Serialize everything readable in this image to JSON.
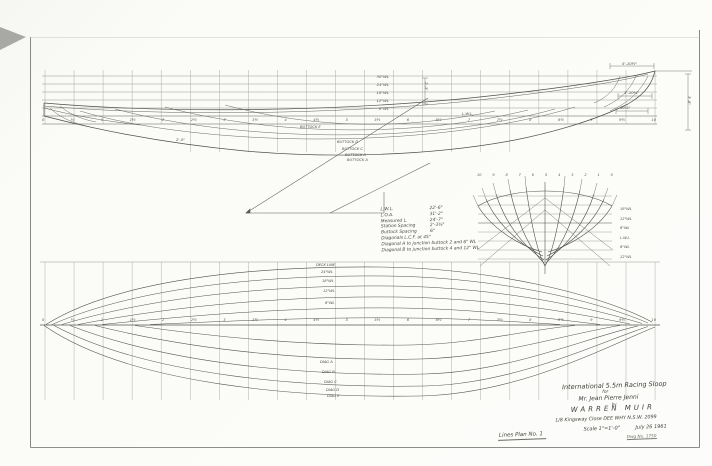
{
  "sheet": {
    "footer_label": "Lines Plan No. 1"
  },
  "title_block": {
    "boat_type": "International 5.5m Racing Sloop",
    "for_word": "for",
    "client": "Mr. Jean Pierre Jenni",
    "by_word": "by",
    "designer": "WARREN  MUIR",
    "address": "1/8 Kingsway Close   DEE WHY   N.S.W. 2099",
    "scale": "Scale 1\"=1'-0\"",
    "date": "July 26 1961",
    "dwg_no": "Dwg No. 1750"
  },
  "spec_table": {
    "rows": [
      [
        "L.W.L.",
        "22'-6\""
      ],
      [
        "L.O.A.",
        "31'-2\""
      ],
      [
        "Measured L.",
        "24'-7\""
      ],
      [
        "Station Spacing",
        "2'-3⅜\""
      ],
      [
        "Buttock Spacing",
        "6\""
      ],
      [
        "Diagonals L.C.F. at 45°",
        ""
      ],
      [
        "Diagonal A to junction buttock 2 and 6\" WL",
        ""
      ],
      [
        "Diagonal B to junction buttock 4 and 12\" WL",
        ""
      ]
    ]
  },
  "profile_view": {
    "waterline_labels": [
      "30\"WL",
      "24\"WL",
      "18\"WL",
      "12\"WL",
      "6\"WL"
    ],
    "lwl_label": "L.W.L.",
    "buttock_labels": [
      "BUTTOCK E",
      "BUTTOCK D",
      "BUTTOCK C",
      "BUTTOCK B",
      "BUTTOCK A"
    ],
    "dims": {
      "d1": "5'-10½\"",
      "d2": "1'-10¾\"",
      "d3": "10⅞\"",
      "d4": "3'-8\"",
      "d5": "2'-0\"",
      "d6": "2'-3\""
    }
  },
  "body_plan": {
    "station_numbers": [
      "10",
      "9",
      "8",
      "7",
      "6",
      "5",
      "4",
      "3",
      "2",
      "1",
      "0"
    ],
    "waterline_labels": [
      "18\"WL",
      "12\"WL",
      "6\"WL",
      "L.W.L.",
      "6\"WL",
      "12\"WL"
    ]
  },
  "half_breadth": {
    "labels_above": [
      "DECK LINE",
      "24\"WL",
      "18\"WL",
      "12\"WL",
      "6\"WL"
    ],
    "labels_below": [
      "DIAG A",
      "DIAG B",
      "DIAG C",
      "DIAG D",
      "DIAG E"
    ]
  },
  "stations": [
    "0",
    "½",
    "1",
    "1½",
    "2",
    "2½",
    "3",
    "3½",
    "4",
    "4½",
    "5",
    "5½",
    "6",
    "6½",
    "7",
    "7½",
    "8",
    "8½",
    "9",
    "9½",
    "10"
  ]
}
